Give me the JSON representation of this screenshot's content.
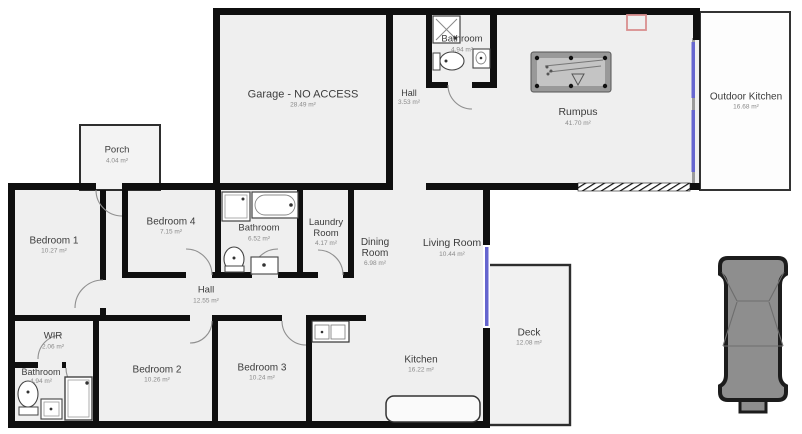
{
  "plan": {
    "type": "residential-floor-plan",
    "colors": {
      "wall": "#0f0f0f",
      "floor": "#efefef",
      "window_accent": "#6363cf",
      "annotation_marker": "#d98f8f",
      "car_body": "#8e8e8e",
      "pool_table_felt": "#c4c4c4"
    },
    "icons": [
      "pool-table-icon",
      "car-icon",
      "toilet-icon",
      "bathtub-icon",
      "shower-icon",
      "sink-icon",
      "kitchen-island-icon",
      "door-arc-icon",
      "window-marker-icon",
      "red-annotation-marker-icon"
    ],
    "rooms": [
      {
        "id": "garage",
        "name": "Garage - NO ACCESS",
        "area": "28.49 m²",
        "x": 303,
        "y": 100,
        "w": 170,
        "size": 11
      },
      {
        "id": "hall-top",
        "name": "Hall",
        "area": "3.53 m²",
        "x": 409,
        "y": 98,
        "w": 40,
        "size": 9
      },
      {
        "id": "bathroom-top",
        "name": "Bathroom",
        "area": "4.94 m²",
        "x": 462,
        "y": 45,
        "w": 70,
        "size": 9.5
      },
      {
        "id": "rumpus",
        "name": "Rumpus",
        "area": "41.70 m²",
        "x": 578,
        "y": 118,
        "w": 90,
        "size": 10.5
      },
      {
        "id": "outdoor-kitchen",
        "name": "Outdoor Kitchen",
        "area": "16.68 m²",
        "x": 746,
        "y": 102,
        "w": 100,
        "size": 10
      },
      {
        "id": "porch",
        "name": "Porch",
        "area": "4.04 m²",
        "x": 117,
        "y": 156,
        "w": 60,
        "size": 9.5
      },
      {
        "id": "bedroom-1",
        "name": "Bedroom 1",
        "area": "10.27 m²",
        "x": 54,
        "y": 246,
        "w": 80,
        "size": 10
      },
      {
        "id": "bedroom-4",
        "name": "Bedroom 4",
        "area": "7.15 m²",
        "x": 171,
        "y": 227,
        "w": 80,
        "size": 10
      },
      {
        "id": "bathroom-mid",
        "name": "Bathroom",
        "area": "6.52 m²",
        "x": 259,
        "y": 234,
        "w": 80,
        "size": 9.5
      },
      {
        "id": "laundry",
        "name": "Laundry Room",
        "area": "4.17 m²",
        "x": 326,
        "y": 234,
        "w": 50,
        "size": 9.5
      },
      {
        "id": "hall-mid",
        "name": "Hall",
        "area": "12.55 m²",
        "x": 206,
        "y": 296,
        "w": 60,
        "size": 9.5
      },
      {
        "id": "dining",
        "name": "Dining Room",
        "area": "6.98 m²",
        "x": 375,
        "y": 254,
        "w": 46,
        "size": 10
      },
      {
        "id": "living",
        "name": "Living Room",
        "area": "10.44 m²",
        "x": 452,
        "y": 249,
        "w": 90,
        "size": 10.5
      },
      {
        "id": "wir",
        "name": "WIR",
        "area": "2.06 m²",
        "x": 53,
        "y": 342,
        "w": 60,
        "size": 9.5
      },
      {
        "id": "bathroom-bl",
        "name": "Bathroom",
        "area": "4.94 m²",
        "x": 41,
        "y": 377,
        "w": 64,
        "size": 9
      },
      {
        "id": "bedroom-2",
        "name": "Bedroom 2",
        "area": "10.26 m²",
        "x": 157,
        "y": 375,
        "w": 90,
        "size": 10
      },
      {
        "id": "bedroom-3",
        "name": "Bedroom 3",
        "area": "10.24 m²",
        "x": 262,
        "y": 373,
        "w": 90,
        "size": 10
      },
      {
        "id": "kitchen",
        "name": "Kitchen",
        "area": "16.22 m²",
        "x": 421,
        "y": 365,
        "w": 80,
        "size": 10
      },
      {
        "id": "deck",
        "name": "Deck",
        "area": "12.08 m²",
        "x": 529,
        "y": 338,
        "w": 60,
        "size": 10
      }
    ]
  }
}
